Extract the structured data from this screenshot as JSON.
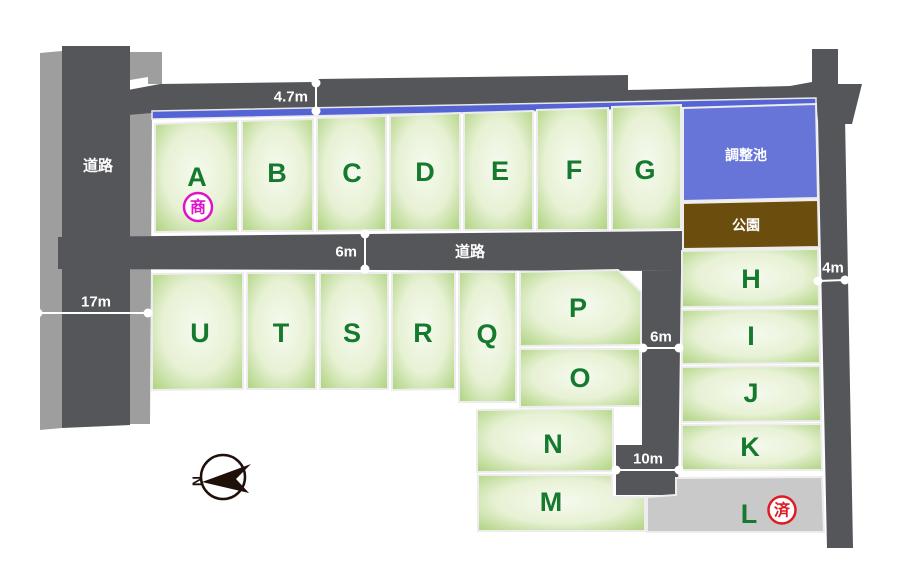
{
  "colors": {
    "road": "#55565a",
    "sidewalk": "#9e9e9e",
    "plot_center": "#f6faef",
    "plot_mid": "#e7f1d4",
    "plot_edge": "#aed37f",
    "plot_letter": "#157a2e",
    "channel": "#5564d4",
    "pond": "#6775d9",
    "park": "#6b4d0e",
    "sold_plot": "#c9c9c9",
    "negotiation": "#e013c9",
    "sold": "#dd1c23",
    "dimension": "#ffffff",
    "compass": "#20100a"
  },
  "roads": {
    "left_label": "道路",
    "middle_label": "道路"
  },
  "areas": {
    "pond_label": "調整池",
    "park_label": "公園"
  },
  "dimensions": {
    "top_road": "4.7m",
    "middle_road": "6m",
    "left_road": "17m",
    "right_road": "4m",
    "inner_road": "6m",
    "cul_de_sac": "10m"
  },
  "plots": {
    "A": {
      "label": "A",
      "status": "商"
    },
    "B": {
      "label": "B"
    },
    "C": {
      "label": "C"
    },
    "D": {
      "label": "D"
    },
    "E": {
      "label": "E"
    },
    "F": {
      "label": "F"
    },
    "G": {
      "label": "G"
    },
    "H": {
      "label": "H"
    },
    "I": {
      "label": "I"
    },
    "J": {
      "label": "J"
    },
    "K": {
      "label": "K"
    },
    "L": {
      "label": "L",
      "status": "済"
    },
    "M": {
      "label": "M"
    },
    "N": {
      "label": "N"
    },
    "O": {
      "label": "O"
    },
    "P": {
      "label": "P"
    },
    "Q": {
      "label": "Q"
    },
    "R": {
      "label": "R"
    },
    "S": {
      "label": "S"
    },
    "T": {
      "label": "T"
    },
    "U": {
      "label": "U"
    }
  },
  "compass": {
    "north_label": "N"
  }
}
